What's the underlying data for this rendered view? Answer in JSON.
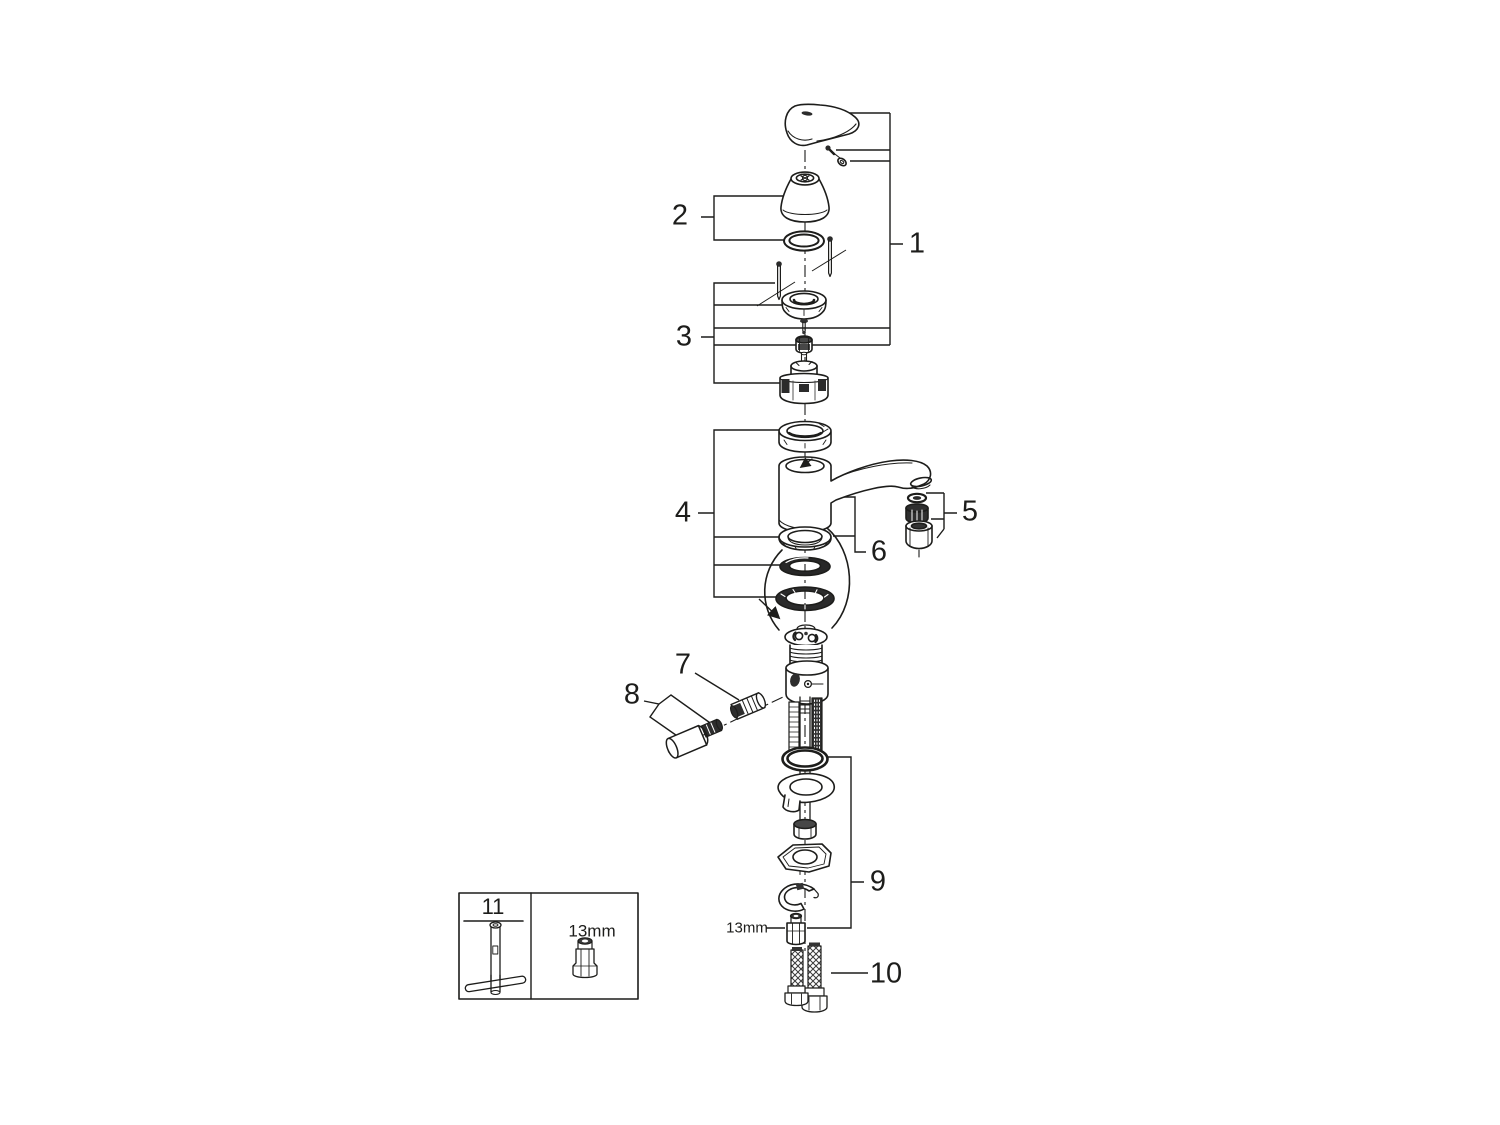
{
  "canvas": {
    "background": "#ffffff",
    "line_color": "#1d1d1b"
  },
  "callouts": {
    "c1": "1",
    "c2": "2",
    "c3": "3",
    "c4": "4",
    "c5": "5",
    "c6": "6",
    "c7": "7",
    "c8": "8",
    "c9": "9",
    "c10": "10",
    "c11": "11"
  },
  "annotations": {
    "adapter_size": "13mm",
    "legend_socket_size": "13mm"
  }
}
